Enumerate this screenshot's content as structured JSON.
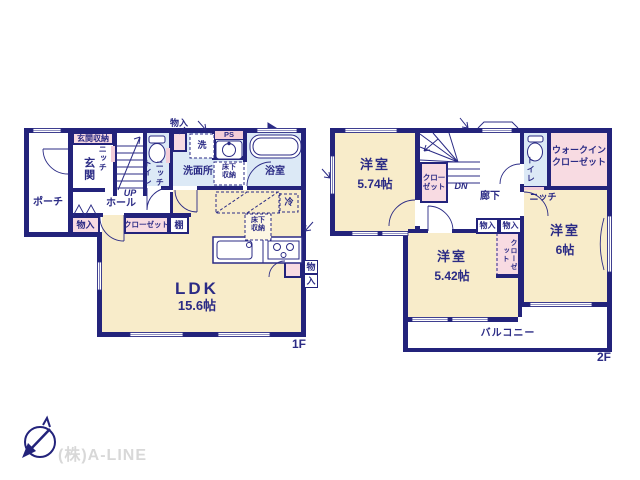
{
  "palette": {
    "wall_navy": "#23237b",
    "text_navy": "#2b2b85",
    "room_cream": "#f8ecca",
    "wet_room_blue": "#dce9f6",
    "closet_pink": "#f8dbe2",
    "company_gray": "#d8d8d8"
  },
  "f1": {
    "floor_label": "1F",
    "porch": "ポーチ",
    "genkan_storage": "玄関収納",
    "genkan": "玄関",
    "niche_a": "ニッチ",
    "niche_b": "ニッチ",
    "up": "UP",
    "hall": "ホール",
    "toilet": "トイレ",
    "storage_top": "物入",
    "washer": "洗",
    "ps": "PS",
    "washroom": "洗面所",
    "underfloor_a": "床下収納",
    "underfloor_b": "床下収納",
    "bath": "浴室",
    "storage_corner": "物入",
    "closet": "クローゼット",
    "shelf": "棚",
    "fridge": "冷",
    "ldk": "LDK",
    "ldk_size": "15.6帖",
    "storage_right_char1": "物",
    "storage_right_char2": "入"
  },
  "f2": {
    "floor_label": "2F",
    "room1": "洋室",
    "room1_size": "5.74帖",
    "closet_by_stairs": "クローゼット",
    "dn": "DN",
    "corridor": "廊下",
    "toilet": "トイレ",
    "wic_line1": "ウォークイン",
    "wic_line2": "クローゼット",
    "niche": "ニッチ",
    "storage_a": "物入",
    "storage_b": "物入",
    "closet_between": "クローゼット",
    "room2": "洋室",
    "room2_size": "5.42帖",
    "room3": "洋室",
    "room3_size": "6帖",
    "balcony": "バルコニー"
  },
  "footer": {
    "company": "(株)A-LINE"
  }
}
